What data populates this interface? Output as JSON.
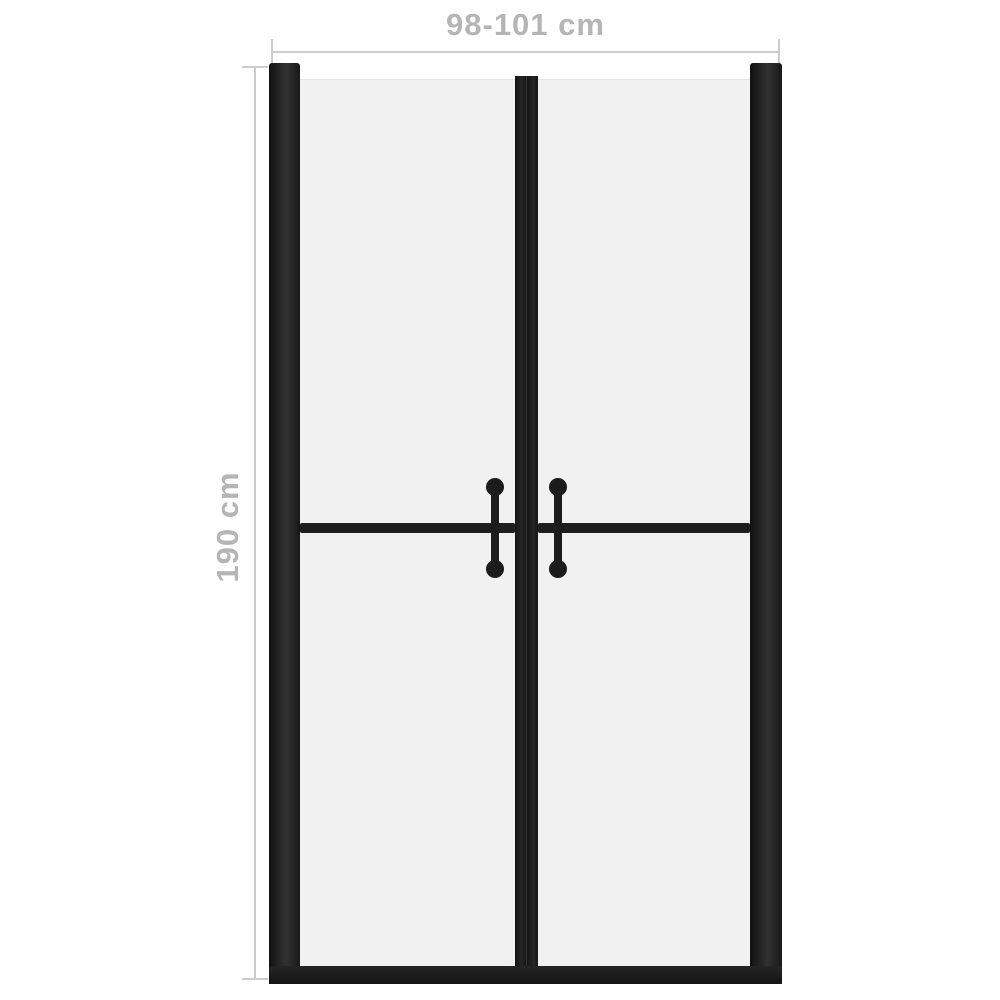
{
  "diagram": {
    "title": "shower-door-dimension-diagram",
    "product": "double swing shower door with frosted glass and black frame"
  },
  "dimensions": {
    "width_label": "98-101 cm",
    "height_label": "190 cm"
  },
  "colors": {
    "background": "#ffffff",
    "frame": "#1b1b1b",
    "glass": "#f1f1f2",
    "dimension_line": "#cccccc",
    "label_text": "#b5b5b5"
  }
}
